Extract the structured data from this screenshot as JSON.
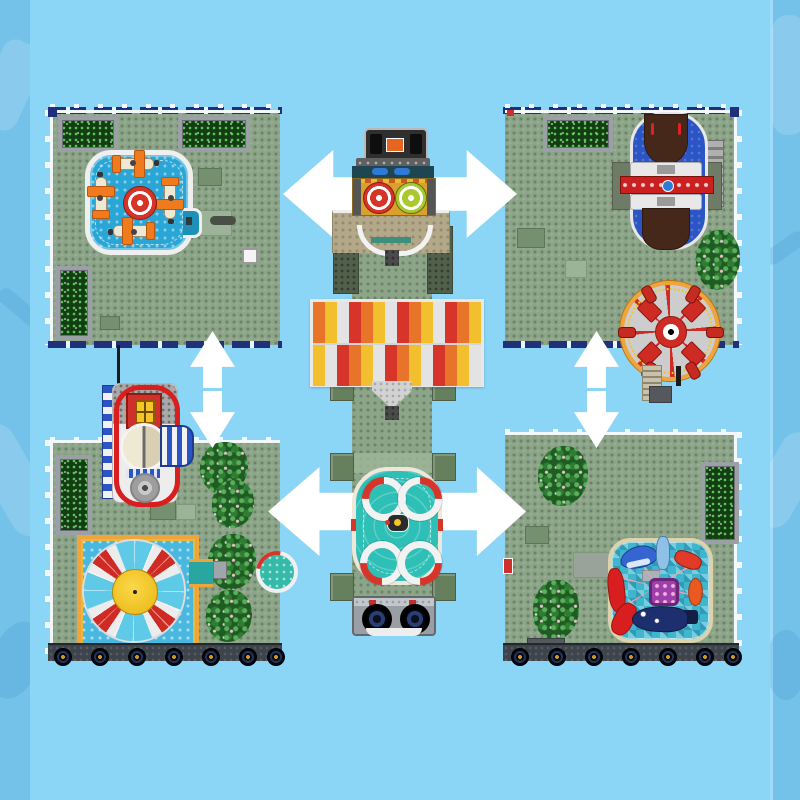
{
  "scene": {
    "name": "modular-amusement-park-baseplates-product-image",
    "modules": {
      "top_left": {
        "name": "plane-spinner-pool-plate"
      },
      "top_right": {
        "name": "pirate-ship-and-ferris-wheel-plate"
      },
      "bottom_left": {
        "name": "carousel-and-disc-spinner-plate"
      },
      "bottom_right": {
        "name": "sea-creature-spinner-pool-plate"
      },
      "center": {
        "name": "park-entrance-walkway-with-awning-fountain-and-cart"
      }
    },
    "arrows": [
      {
        "name": "swap-arrow-top",
        "orientation": "horizontal",
        "direction": "both"
      },
      {
        "name": "swap-arrow-middle",
        "orientation": "horizontal",
        "direction": "both"
      },
      {
        "name": "swap-arrow-left",
        "orientation": "vertical",
        "direction": "both"
      },
      {
        "name": "swap-arrow-right",
        "orientation": "vertical",
        "direction": "both"
      }
    ]
  },
  "colors": {
    "bg": "#8BD5F6",
    "strip": "#74C2EA",
    "plate": "#8CA488",
    "navy": "#20307A",
    "arrow": "#FFFFFF",
    "pool-blue": "#2AA6D6",
    "teal": "#2EC0B6",
    "awning-red": "#D7342A",
    "awning-orange": "#E8732A",
    "awning-yellow": "#F2C02E",
    "awning-white": "#E3E3E3",
    "hub-red": "#D63426",
    "wing-orange": "#F07A1E",
    "ship-brown": "#46281A",
    "track-blue": "#2B55C4",
    "wheel-trim": "#F0A43C",
    "seat-blue": "#5FC9E8",
    "spinner-yellow": "#F5C623",
    "creature-red": "#D81E1E",
    "shark-blue": "#3565D0",
    "whale-navy": "#1D2F6E",
    "purple": "#9C3FA8",
    "cart-gray": "#999FA4",
    "khaki": "#B3A98A"
  }
}
